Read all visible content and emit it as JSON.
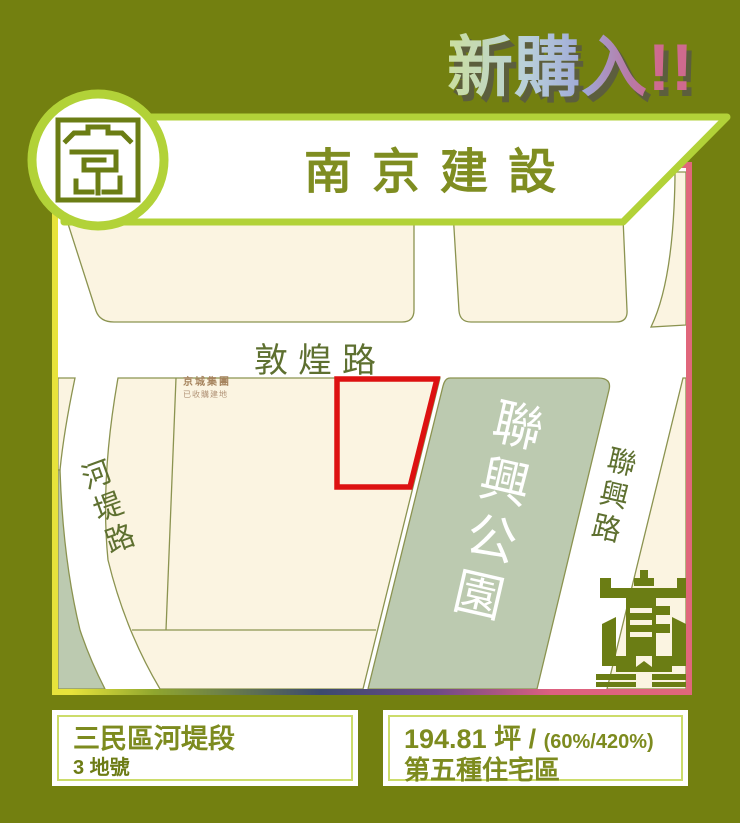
{
  "title": {
    "text": "新購入!!"
  },
  "banner": {
    "company": "南京建設"
  },
  "map": {
    "road_top": "敦煌路",
    "road_left": "河堤路",
    "road_right": "聯興路",
    "park": "聯興公園",
    "annotation_line1": "京城集團",
    "annotation_line2": "已收購建地"
  },
  "info_left": {
    "title": "三民區河堤段",
    "lot": "3 地號"
  },
  "info_right": {
    "area": "194.81 坪 /",
    "ratio": "(60%/420%)",
    "zoning": "第五種住宅區"
  },
  "colors": {
    "background": "#738010",
    "accent_green": "#b2d238",
    "olive_text": "#7f8d21",
    "cream_block": "#fbf4e1",
    "park_green": "#bccab0",
    "parcel_red": "#dd1111",
    "edge_pink": "#e0677b",
    "edge_yellow": "#e7e33b"
  }
}
